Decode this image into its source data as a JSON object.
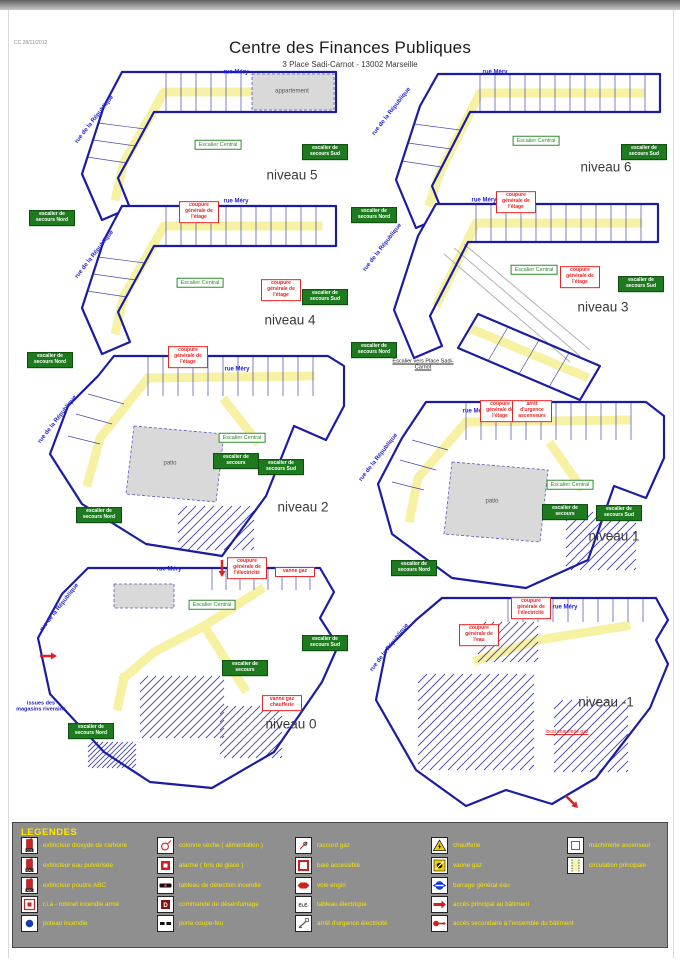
{
  "page": {
    "ref": "CC 28/11/2012",
    "title": "Centre des Finances Publiques",
    "subtitle": "3 Place Sadi-Carnot - 13002 Marseille"
  },
  "colors": {
    "wall_blue": "#1c1ca2",
    "circulation_yellow": "#f6f1a3",
    "exit_green": "#1e7a1e",
    "cutoff_red": "#e22222",
    "street_blue": "#2222dd",
    "legend_bg": "#8f8f8f",
    "legend_text": "#f5e400"
  },
  "floors": [
    {
      "id": "n5",
      "name": "niveau 5",
      "street_top": "rue Méry",
      "street_side": "rue de la République",
      "area_label": "appartement",
      "labels": [
        {
          "text": "Escalier Central",
          "type": "green-outline"
        },
        {
          "text": "escalier de secours Sud",
          "type": "green"
        },
        {
          "text": "escalier de secours Nord",
          "type": "green"
        }
      ]
    },
    {
      "id": "n6",
      "name": "niveau 6",
      "street_top": "rue Méry",
      "street_side": "rue de la République",
      "labels": [
        {
          "text": "Escalier Central",
          "type": "green-outline"
        },
        {
          "text": "escalier de secours Sud",
          "type": "green"
        },
        {
          "text": "escalier de secours Nord",
          "type": "green"
        }
      ]
    },
    {
      "id": "n4",
      "name": "niveau 4",
      "street_top": "rue Méry",
      "street_side": "rue de la République",
      "labels": [
        {
          "text": "Escalier Central",
          "type": "green-outline"
        },
        {
          "text": "escalier de secours Sud",
          "type": "green"
        },
        {
          "text": "escalier de secours Nord",
          "type": "green"
        },
        {
          "text": "coupure générale de l'étage",
          "type": "red"
        },
        {
          "text": "coupure générale de l'étage",
          "type": "red"
        }
      ]
    },
    {
      "id": "n3",
      "name": "niveau 3",
      "street_top": "rue Méry",
      "street_side": "rue de la République",
      "labels": [
        {
          "text": "Escalier Central",
          "type": "green-outline"
        },
        {
          "text": "escalier de secours Sud",
          "type": "green"
        },
        {
          "text": "escalier de secours Nord",
          "type": "green"
        },
        {
          "text": "coupure générale de l'étage",
          "type": "red"
        },
        {
          "text": "coupure générale de l'étage",
          "type": "red"
        },
        {
          "text": "Escalier vers Place Sadi-Carnot",
          "type": "plain"
        }
      ]
    },
    {
      "id": "n2",
      "name": "niveau 2",
      "street_top": "rue Méry",
      "street_side": "rue de la République",
      "area_label": "patio",
      "labels": [
        {
          "text": "Escalier Central",
          "type": "green-outline"
        },
        {
          "text": "escalier de secours",
          "type": "green"
        },
        {
          "text": "escalier de secours Sud",
          "type": "green"
        },
        {
          "text": "escalier de secours Nord",
          "type": "green"
        },
        {
          "text": "coupure générale de l'étage",
          "type": "red"
        }
      ]
    },
    {
      "id": "n1",
      "name": "niveau 1",
      "street_top": "rue Méry",
      "street_side": "rue de la République",
      "area_label": "patio",
      "labels": [
        {
          "text": "Escalier Central",
          "type": "green-outline"
        },
        {
          "text": "escalier de secours",
          "type": "green"
        },
        {
          "text": "escalier de secours Sud",
          "type": "green"
        },
        {
          "text": "escalier de secours Nord",
          "type": "green"
        },
        {
          "text": "coupure générale de l'étage",
          "type": "red"
        },
        {
          "text": "arrêt d'urgence ascenseurs",
          "type": "red"
        }
      ]
    },
    {
      "id": "n0",
      "name": "niveau 0",
      "street_top": "rue Méry",
      "street_side": "rue de la République",
      "labels": [
        {
          "text": "Escalier Central",
          "type": "green-outline"
        },
        {
          "text": "escalier de secours",
          "type": "green"
        },
        {
          "text": "escalier de secours Sud",
          "type": "green"
        },
        {
          "text": "escalier de secours Nord",
          "type": "green"
        },
        {
          "text": "coupure générale de l'électricité",
          "type": "red"
        },
        {
          "text": "vanne gaz",
          "type": "red"
        },
        {
          "text": "vanne gaz chaufferie",
          "type": "red"
        },
        {
          "text": "issues des magasins riverains",
          "type": "blue"
        }
      ]
    },
    {
      "id": "nm1",
      "name": "niveau -1",
      "street_top": "rue Méry",
      "street_side": "rue de la République",
      "labels": [
        {
          "text": "coupure générale de l'électricité",
          "type": "red"
        },
        {
          "text": "coupure générale de l'eau",
          "type": "red"
        },
        {
          "text": "local chaufferie gaz",
          "type": "red-plain"
        }
      ]
    }
  ],
  "legend": {
    "heading": "LEGENDES",
    "columns": [
      [
        {
          "icon": "extinguisher-co2",
          "label": "extincteur dioxyde de carbone"
        },
        {
          "icon": "extinguisher-water",
          "label": "extincteur eau pulvérisée"
        },
        {
          "icon": "extinguisher-powder",
          "label": "extincteur poudre ABC"
        },
        {
          "icon": "ria",
          "label": "r.i.a - robinet incendie armé"
        },
        {
          "icon": "hydrant",
          "label": "poteau incendie"
        }
      ],
      [
        {
          "icon": "dry-column",
          "label": "colonne sèche ( alimentation )"
        },
        {
          "icon": "alarm",
          "label": "alarme ( bris de glace )"
        },
        {
          "icon": "fire-detection-panel",
          "label": "tableau de détection incendie"
        },
        {
          "icon": "smoke-control",
          "label": "commande de désenfumage"
        },
        {
          "icon": "fire-door",
          "label": "porte coupe-feu"
        }
      ],
      [
        {
          "icon": "gas-connection",
          "label": "raccord gaz"
        },
        {
          "icon": "accessible-bay",
          "label": "baie accessible"
        },
        {
          "icon": "fire-lane",
          "label": "voie engin"
        },
        {
          "icon": "electrical-panel",
          "label": "tableau électrique"
        },
        {
          "icon": "electric-emergency-stop",
          "label": "arrêt d'urgence électricité"
        }
      ],
      [
        {
          "icon": "boiler",
          "label": "chaufferie"
        },
        {
          "icon": "gas-valve",
          "label": "vanne gaz"
        },
        {
          "icon": "water-shutoff",
          "label": "barrage général eau"
        },
        {
          "icon": "main-access",
          "label": "accès principal au bâtiment"
        },
        {
          "icon": "secondary-access",
          "label": "accès secondaire à l'ensemble du bâtiment"
        }
      ],
      [
        {
          "icon": "elevator-machinery",
          "label": "machinerie ascenseur"
        },
        {
          "icon": "main-circulation",
          "label": "circulation principale"
        }
      ]
    ]
  }
}
